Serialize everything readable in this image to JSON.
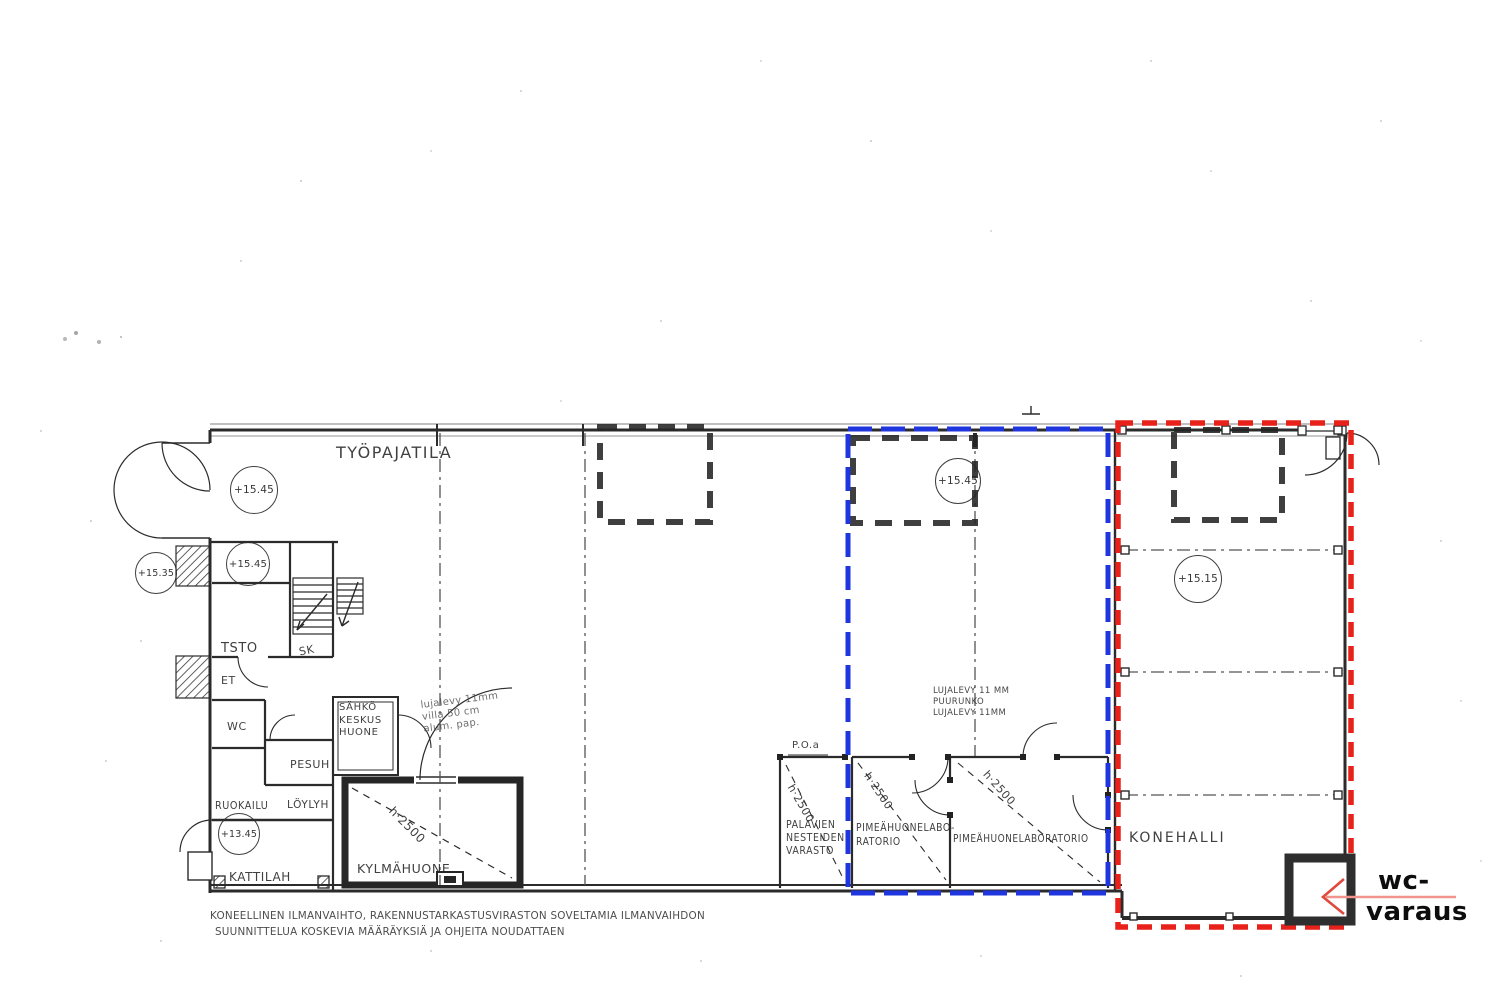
{
  "plan": {
    "workshop_label": "TYÖPAJATILA",
    "rooms": {
      "tsto": "TSTO",
      "sk": "SK",
      "et": "ET",
      "wc": "WC",
      "pesuh": "PESUH",
      "ruokailu": "RUOKAILU",
      "loylyh": "LÖYLYH",
      "kattilah": "KATTILAH",
      "sahko": [
        "SÄHKÖ",
        "KESKUS",
        "HUONE"
      ],
      "kylmahuone": "KYLMÄHUONE",
      "palavien": [
        "PALAVIEN",
        "NESTEIDEN",
        "VARASTO"
      ],
      "lab1": [
        "PIMEÄHUONELABO-",
        "RATORIO"
      ],
      "lab2": "PIMEÄHUONELABORATORIO",
      "konehalli": "KONEHALLI",
      "poa": "P.O.a"
    },
    "levels": [
      "+15.45",
      "+15.35",
      "+15.45",
      "+13.45",
      "+15.45",
      "+15.15"
    ],
    "height_note": "h·2500",
    "wall_note": [
      "LUJALEVY 11 MM",
      "PUURUNKO",
      "LUJALEVY 11MM"
    ],
    "pencil_note": [
      "lujalevy 11mm",
      "villa 50 cm",
      "alum. pap."
    ],
    "footer_note": [
      "KONEELLINEN ILMANVAIHTO, RAKENNUSTARKASTUSVIRASTON SOVELTAMIA ILMANVAIHDON",
      "SUUNNITTELUA KOSKEVIA MÄÄRÄYKSIÄ JA OHJEITA NOUDATTAEN"
    ]
  },
  "annotations": {
    "wc_reservation": {
      "line1": "wc-",
      "line2": "varaus"
    },
    "colors": {
      "blue_zone": "#1F35DD",
      "red_zone": "#E8211A",
      "arrow": "#EA5A4D"
    }
  }
}
